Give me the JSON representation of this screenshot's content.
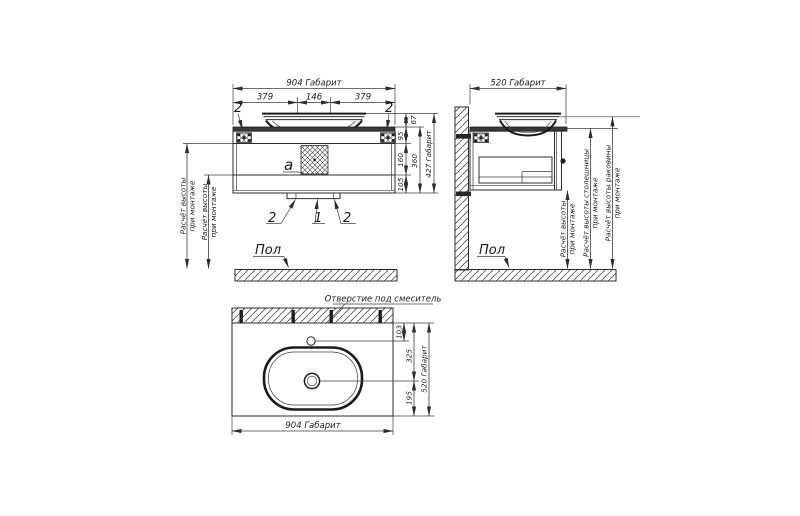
{
  "front_view": {
    "dim_width_overall": "904 Габарит",
    "dim_left_segment": "379",
    "dim_center_segment": "146",
    "dim_right_segment": "379",
    "bracket_callout_left": "2",
    "bracket_callout_right": "2",
    "siphon_area_label": "a",
    "dim_bowl_above_top": "67",
    "dim_upper_section": "95",
    "dim_middle_section": "160",
    "dim_lower_section": "105",
    "dim_cabinet_height": "360",
    "dim_height_overall": "427 Габарит",
    "callout_bottom_left": "2",
    "callout_bottom_center": "1",
    "callout_bottom_right": "2",
    "calc_outer_line1": "Расчёт высоты",
    "calc_outer_line2": "при монтаже",
    "calc_inner_line1": "Расчёт высоты",
    "calc_inner_line2": "при монтаже",
    "floor_label": "Пол"
  },
  "side_view": {
    "dim_depth_overall": "520 Габарит",
    "floor_label": "Пол",
    "calc_height_line1": "Расчёт высоты",
    "calc_height_line2": "при монтаже",
    "calc_countertop_line1": "Расчёт высоты столешницы",
    "calc_countertop_line2": "при монтаже",
    "calc_basin_line1": "Расчёт высоты раковины",
    "calc_basin_line2": "при монтаже"
  },
  "top_view": {
    "faucet_hole_label": "Отверстие под смеситель",
    "dim_faucet_offset": "103",
    "dim_drain_offset": "325",
    "dim_front_offset": "195",
    "dim_depth_overall": "520 Габарит",
    "dim_width_overall": "904 Габарит"
  }
}
